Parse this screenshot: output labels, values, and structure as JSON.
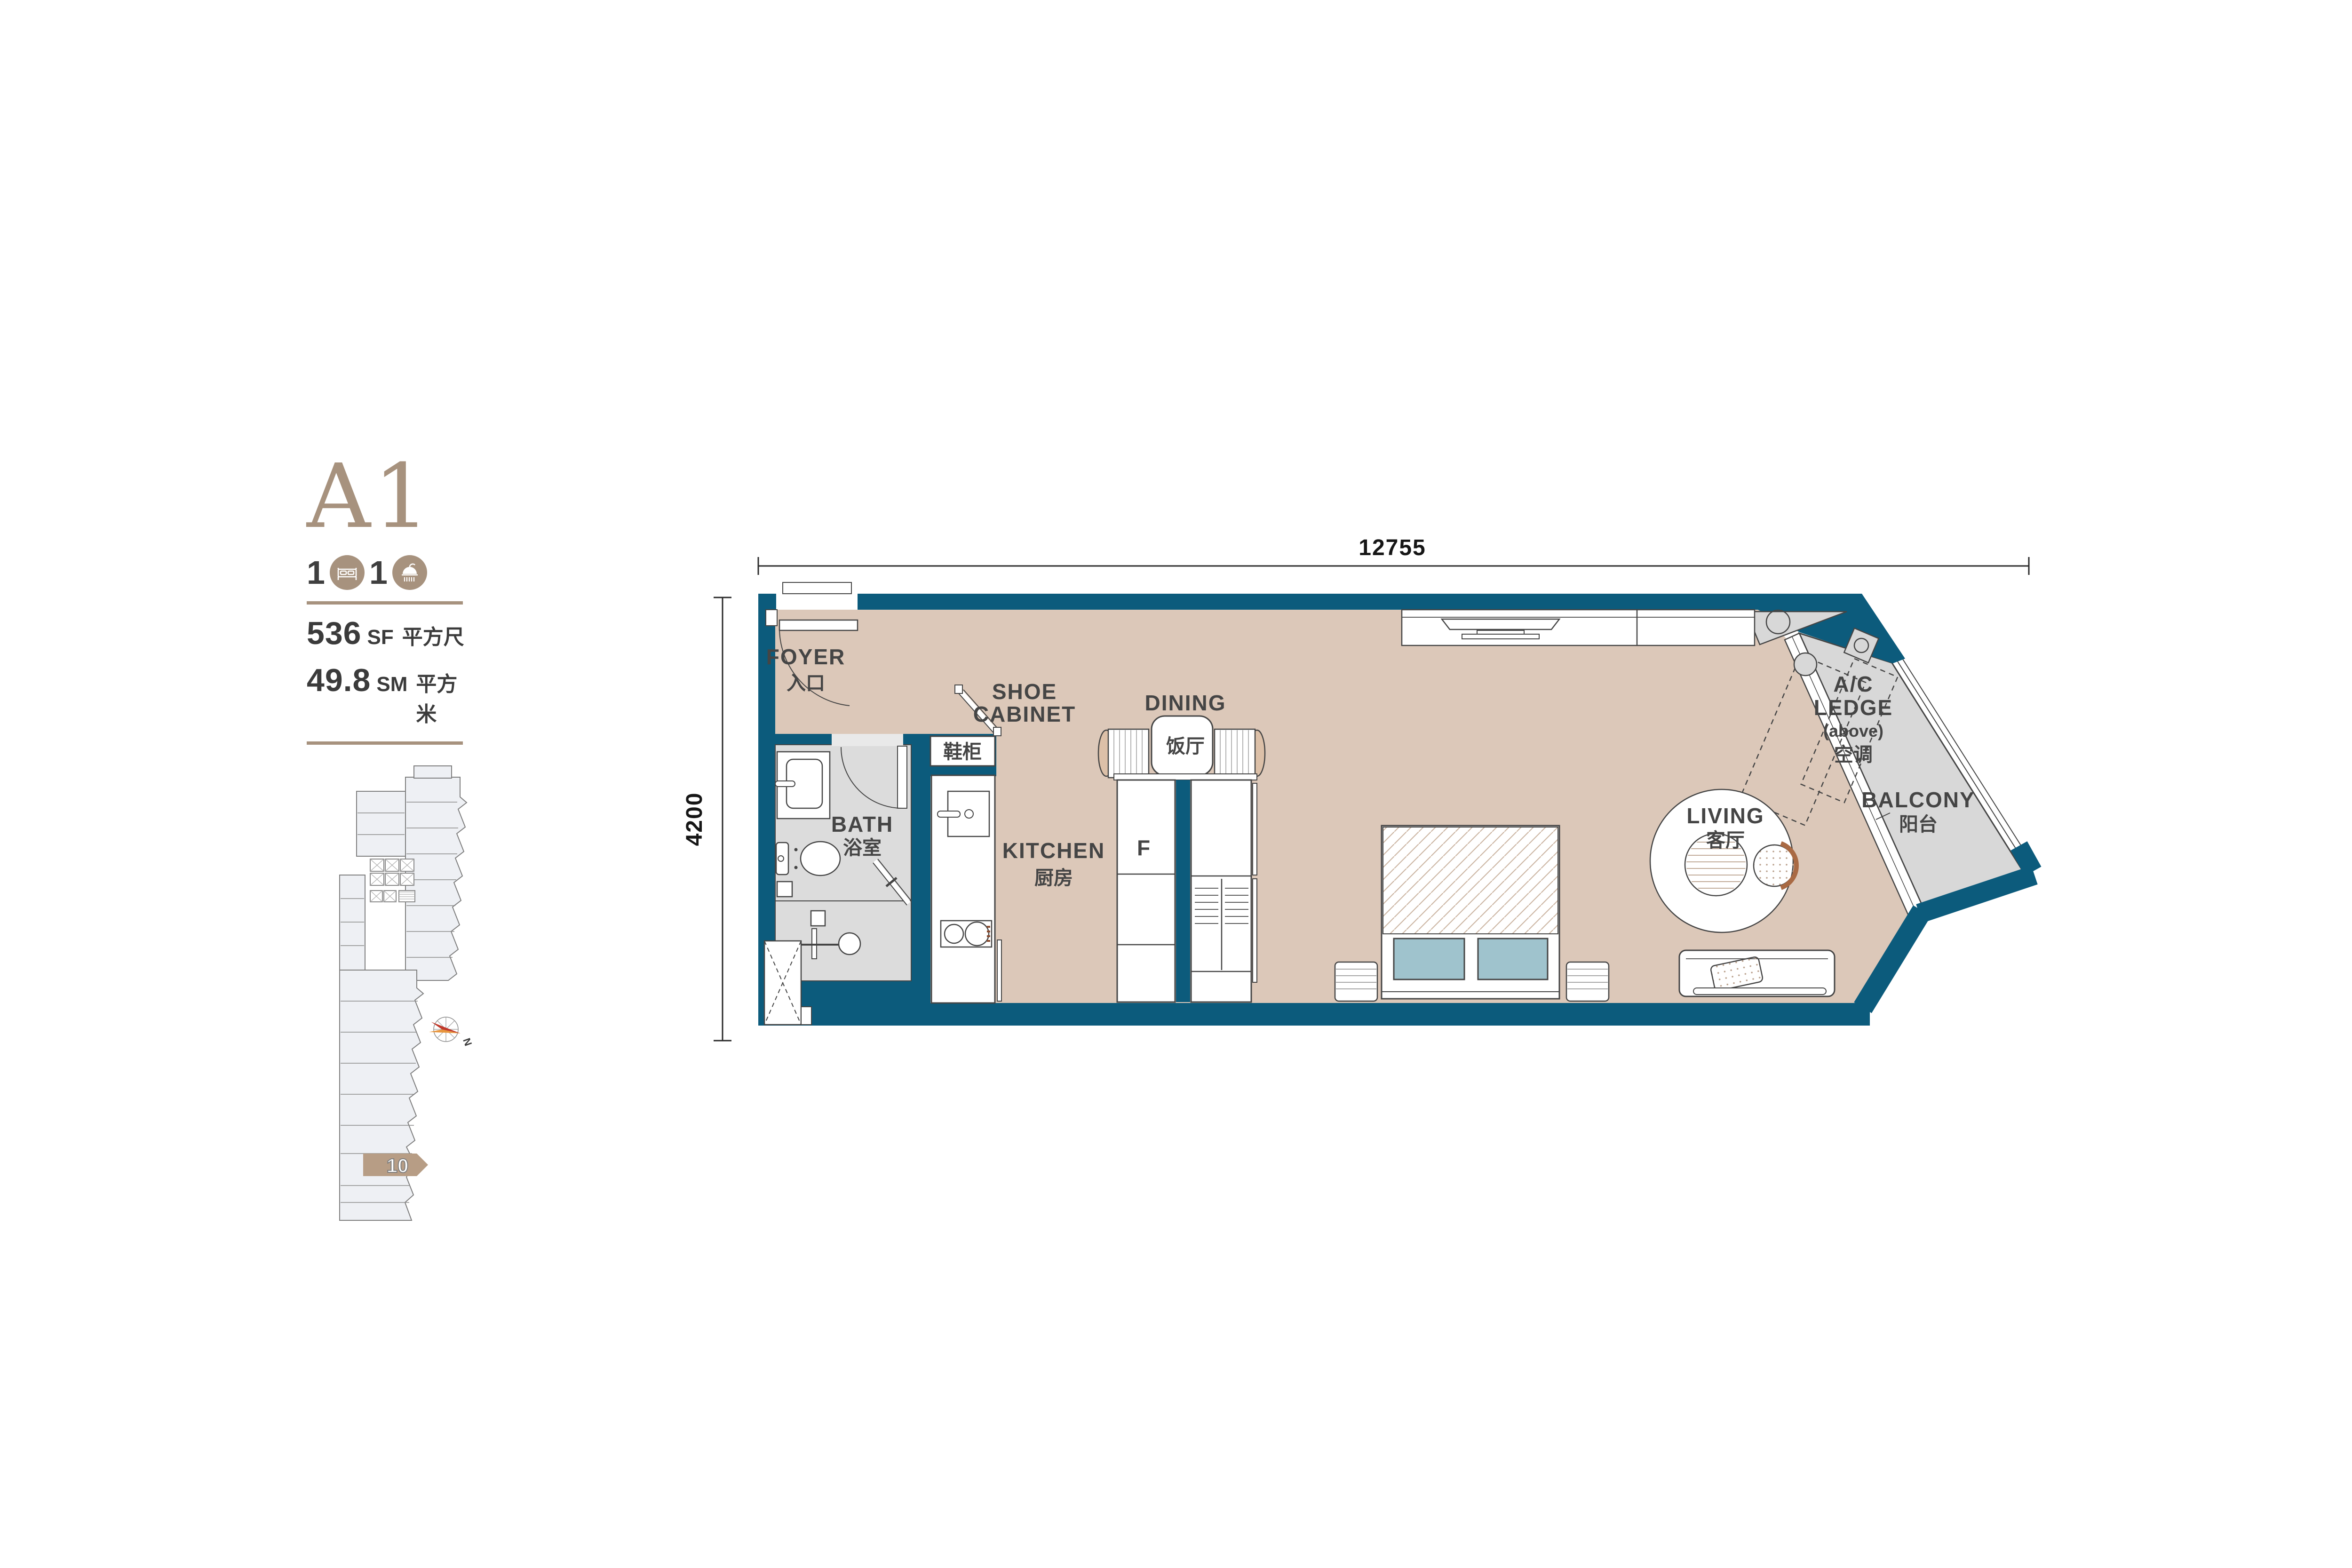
{
  "unit_panel": {
    "unit_name": "A1",
    "bedroom_count": "1",
    "bathroom_count": "1",
    "area_sf": "536",
    "area_sf_unit": "SF",
    "area_sf_cn": "平方尺",
    "area_sm": "49.8",
    "area_sm_unit": "SM",
    "area_sm_cn": "平方米",
    "accent_color": "#a7927e",
    "keyplan": {
      "highlight_label": "10",
      "compass_label": "N",
      "highlight_color": "#b79d85"
    }
  },
  "floor_plan": {
    "dim_width": "12755",
    "dim_height": "4200",
    "colors": {
      "wall_teal": "#0c5b7c",
      "floor_tan": "#dcc8b9",
      "wet_area_grey": "#dcdcdc",
      "balcony_grey": "#d8d8d8",
      "pillow_blue": "#9fc3cd",
      "line_dark": "#454545"
    },
    "rooms": {
      "foyer": {
        "en": "FOYER",
        "cn": "入口"
      },
      "shoe_cabinet": {
        "en_line1": "SHOE",
        "en_line2": "CABINET",
        "cn": "鞋柜"
      },
      "bath": {
        "en": "BATH",
        "cn": "浴室"
      },
      "kitchen": {
        "en": "KITCHEN",
        "cn": "厨房"
      },
      "dining": {
        "en": "DINING",
        "cn": "饭厅"
      },
      "living": {
        "en": "LIVING",
        "cn": "客厅"
      },
      "fridge": "F",
      "ac_ledge": {
        "line1": "A/C",
        "line2": "LEDGE",
        "line3": "(above)",
        "cn": "空调"
      },
      "balcony": {
        "en": "BALCONY",
        "cn": "阳台"
      }
    }
  }
}
